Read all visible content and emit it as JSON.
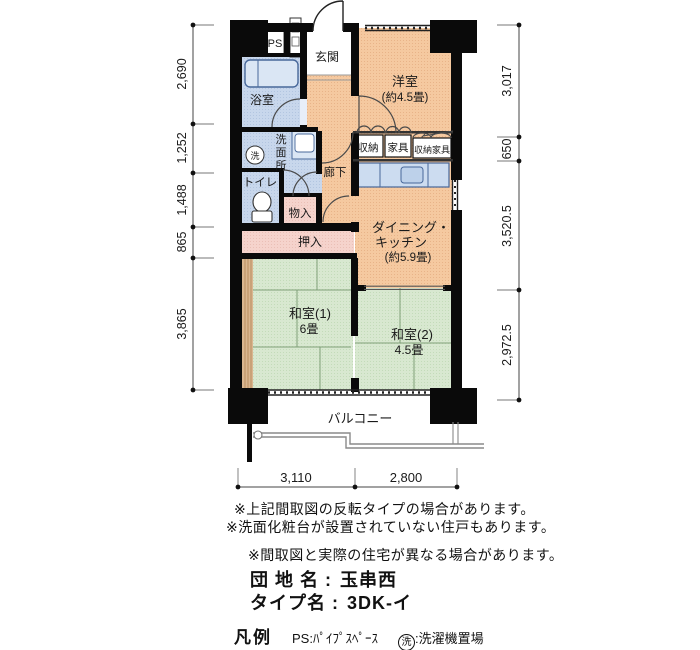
{
  "floorplan": {
    "rooms": {
      "ps": "PS",
      "genkan": "玄関",
      "yoshitsu": "洋室",
      "yoshitsu_size": "(約4.5畳)",
      "bathroom": "浴室",
      "washroom_chars": [
        "洗",
        "面",
        "所"
      ],
      "washer_symbol": "洗",
      "toilet": "トイレ",
      "storage": "収納",
      "furniture": "家具",
      "storage_furniture": "収納家具",
      "hallway": "廊下",
      "monoire": "物入",
      "oshiire": "押入",
      "dk_line1": "ダイニング・",
      "dk_line2": "キッチン",
      "dk_size": "(約5.9畳)",
      "washitsu1": "和室(1)",
      "washitsu1_size": "6畳",
      "washitsu2": "和室(2)",
      "washitsu2_size": "4.5畳",
      "balcony": "バルコニー"
    },
    "dimensions": {
      "left": [
        "2,690",
        "1,252",
        "1,488",
        "865",
        "3,865"
      ],
      "right": [
        "3,017",
        "650",
        "3,520.5",
        "2,972.5"
      ],
      "bottom": [
        "3,110",
        "2,800"
      ]
    }
  },
  "notes": {
    "note1": "※上記間取図の反転タイプの場合があります。",
    "note2": "※洗面化粧台が設置されていない住戸もあります。",
    "note3": "※間取図と実際の住宅が異なる場合があります。"
  },
  "property": {
    "estate_label": "団 地 名 :",
    "estate_name": "玉串西",
    "type_label": "タイプ名 :",
    "type_name": "3DK-イ"
  },
  "legend": {
    "title": "凡例",
    "ps_desc": "PS:ﾊﾟｲﾌﾟｽﾍﾟｰｽ",
    "washer_symbol": "洗",
    "washer_desc": ":洗濯機置場"
  },
  "colors": {
    "room_orange": "#f5c9a0",
    "room_blue": "#c8d7ec",
    "room_green": "#d8e8d0",
    "closet_pink": "#f5d3cc",
    "wood_tan": "#dab690",
    "fixture_blue": "#ccdcf0",
    "wall_black": "#0a0a0a"
  }
}
